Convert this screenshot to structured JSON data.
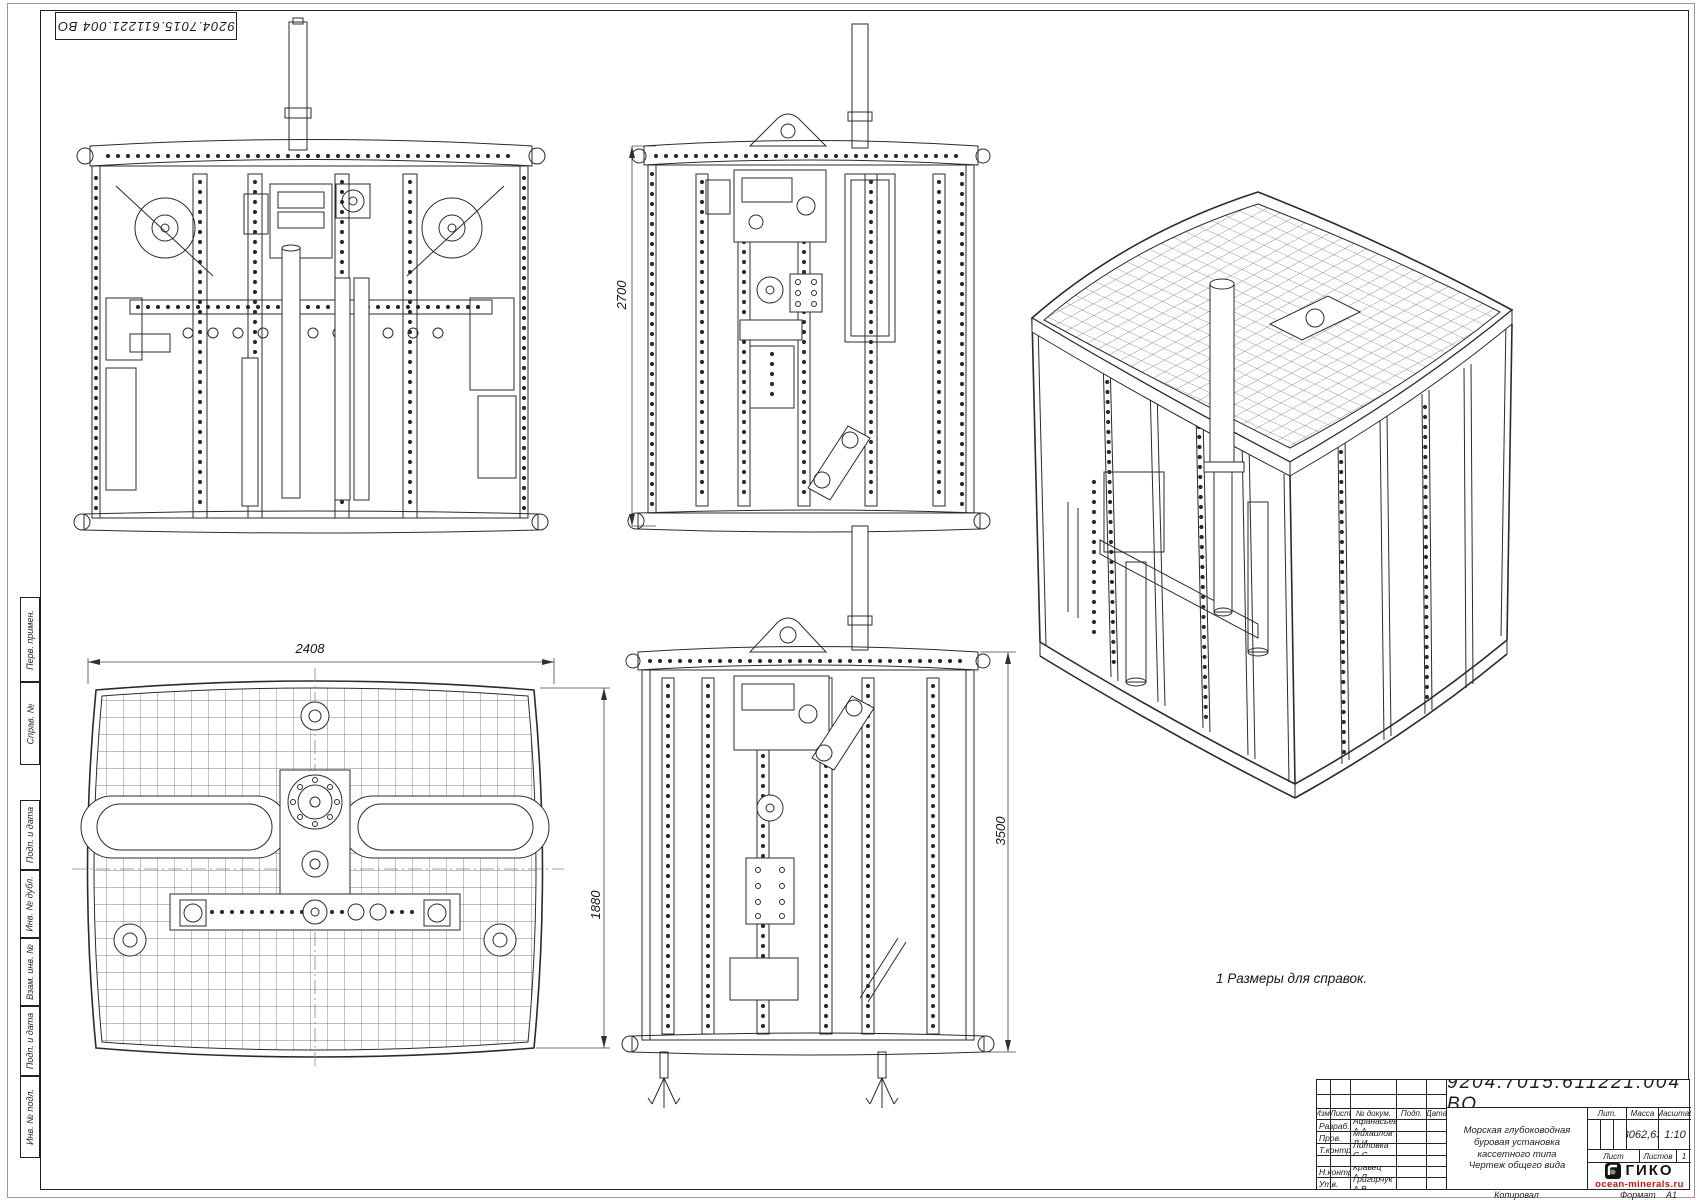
{
  "sheet": {
    "doc_number_stamp": "9204.7015.611221.004 ВО",
    "note": "1 Размеры для справок.",
    "footer": {
      "copied_label": "Копировал",
      "format_label": "Формат",
      "format_value": "А1"
    }
  },
  "margin_labels": {
    "perv_primen": "Перв. примен.",
    "sprav_no": "Справ. №",
    "podp_data_1": "Подп. и дата",
    "inv_dubl": "Инв. № дубл.",
    "vzam_inv": "Взам. инв. №",
    "podp_data_2": "Подп. и дата",
    "inv_podl": "Инв. № подл."
  },
  "dimensions": {
    "front_height": "2700",
    "plan_width": "2408",
    "plan_depth": "1880",
    "side_height": "3500"
  },
  "title_block": {
    "doc_number": "9204.7015.611221.004 ВО",
    "header_cols": [
      "Изм.",
      "Лист",
      "№ докум.",
      "Подп.",
      "Дата"
    ],
    "rows": [
      {
        "role": "Разраб.",
        "name": "Афанасьев А.А."
      },
      {
        "role": "Пров.",
        "name": "Михайлов Д.И."
      },
      {
        "role": "Т.контр.",
        "name": "Литовка С.С."
      },
      {
        "role": "",
        "name": ""
      },
      {
        "role": "Н.контр.",
        "name": "Кравец А.Л."
      },
      {
        "role": "Утв.",
        "name": "Григорчук А.В."
      }
    ],
    "title_lines": [
      "Морская глубоководная",
      "буровая установка",
      "кассетного типа",
      "Чертеж общего вида"
    ],
    "lit_label": "Лит.",
    "mass_label": "Масса",
    "scale_label": "Масштаб",
    "mass_value": "3062,63",
    "scale_value": "1:10",
    "sheet_label": "Лист",
    "sheets_label": "Листов",
    "sheets_value": "1",
    "logo_text": "ГИКО",
    "logo_url": "ocean-minerals.ru"
  }
}
